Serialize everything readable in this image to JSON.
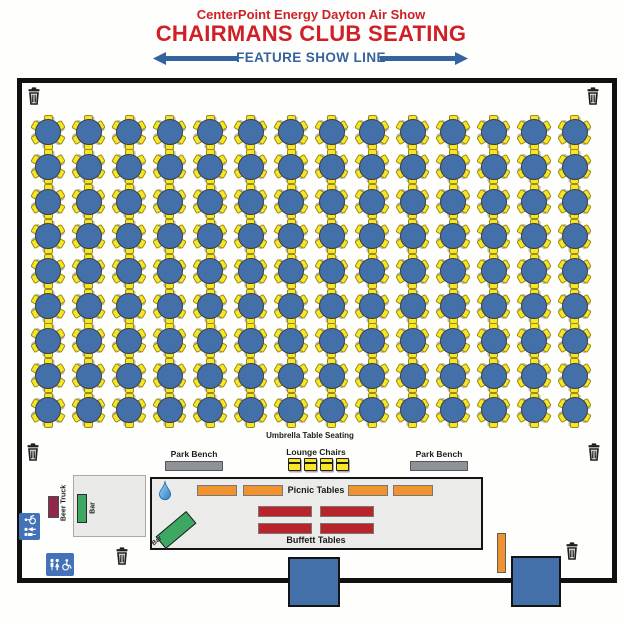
{
  "header": {
    "subtitle": "CenterPoint Energy Dayton Air Show",
    "title": "CHAIRMANS CLUB SEATING",
    "feature_line": "FEATURE SHOW LINE"
  },
  "seating": {
    "label": "Umbrella Table Seating",
    "rows": 9,
    "cols": 14,
    "table_count": 126,
    "chairs_per_table": 6
  },
  "amenities": {
    "park_bench_left": "Park Bench",
    "park_bench_right": "Park Bench",
    "lounge_chairs_label": "Lounge Chairs",
    "lounge_chair_count": 4,
    "picnic_label": "Picnic Tables",
    "picnic_table_count": 4,
    "buffet_label": "Buffett Tables",
    "buffet_table_count": 4,
    "bar_diagonal_label": "Bar",
    "bar_vertical_label": "Bar",
    "beer_truck_label": "Beer Truck"
  },
  "icons": {
    "trash_can_count": 6,
    "restroom_sign_count": 2,
    "water_drop": "water-drop-icon"
  },
  "colors": {
    "title_red": "#cf2027",
    "line_blue": "#35639f",
    "table_blue": "#4470aa",
    "chair_yellow": "#f6e626",
    "bench_gray": "#8f9296",
    "picnic_orange": "#f0922d",
    "buffet_red": "#b8242a",
    "bar_green": "#3ea863",
    "beer_truck_maroon": "#90284e",
    "sign_blue": "#4472b8",
    "structure_blue": "#4470aa"
  }
}
